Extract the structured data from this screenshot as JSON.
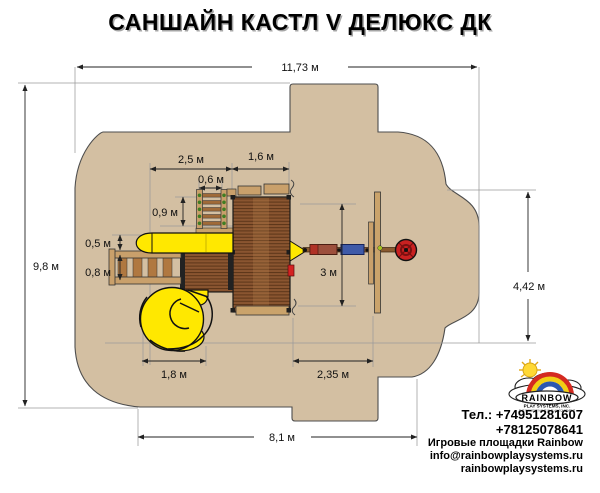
{
  "title": "САНШАЙН КАСТЛ V ДЕЛЮКС ДК",
  "dims": {
    "total_width": "11,73 м",
    "total_height": "9,8 м",
    "right_section_height": "4,42 м",
    "deck_offset": "2,5 м",
    "main_deck_width": "1,6 м",
    "climb_wall_width": "0,6 м",
    "climb_wall_depth": "0,9 м",
    "slide_width": "0,5 м",
    "ladder_width": "0,8 м",
    "swing_clearance": "3 м",
    "spiral_slide_width": "1,8 м",
    "swing_bay_width": "2,35 м",
    "base_width": "8,1 м"
  },
  "contact": {
    "phone1": "Тел.: +74951281607",
    "phone2": "+78125078641",
    "caption": "Игровые площадки Rainbow",
    "email": "info@rainbowplaysystems.ru",
    "website": "rainbowplaysystems.ru"
  },
  "logo": {
    "brand": "RAINBOW",
    "company": "PLAY SYSTEMS, INC.",
    "tagline": "THE BIGGEST NAME IN PLAY EQUIPMENT"
  },
  "colors": {
    "ground": "#d3bfa2",
    "slide_yellow": "#ffe800",
    "deck_wood": "#8a5530",
    "rail_wood": "#c9a06b",
    "tire_swing_red": "#c92121",
    "swing_seat_blue": "#3f5aa8",
    "swing_seat_red": "#9c4f3c",
    "climb_hold_green": "#3f7d23"
  }
}
